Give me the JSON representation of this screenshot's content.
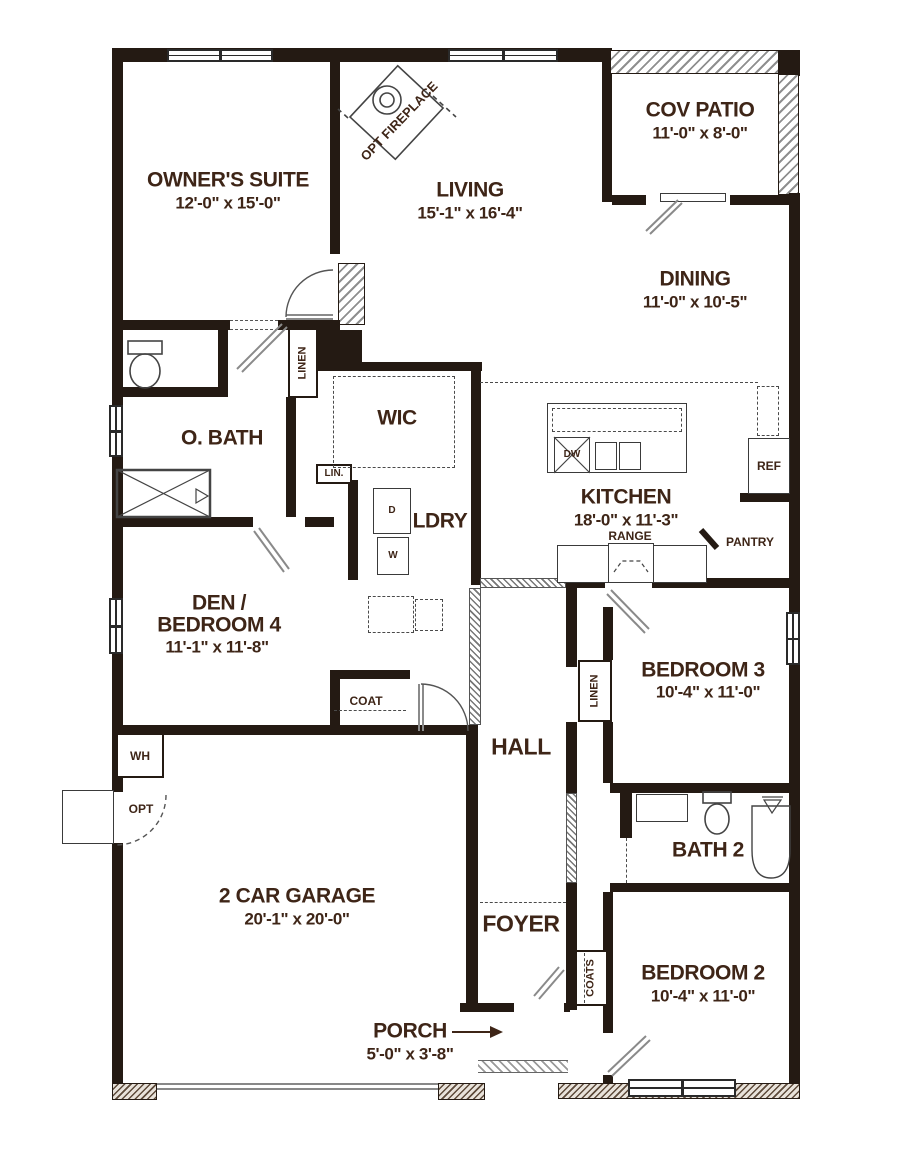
{
  "rooms": {
    "owners_suite": {
      "name": "OWNER'S SUITE",
      "dims": "12'-0\" x 15'-0\""
    },
    "living": {
      "name": "LIVING",
      "dims": "15'-1\" x 16'-4\""
    },
    "cov_patio": {
      "name": "COV PATIO",
      "dims": "11'-0\" x 8'-0\""
    },
    "dining": {
      "name": "DINING",
      "dims": "11'-0\" x 10'-5\""
    },
    "o_bath": {
      "name": "O. BATH"
    },
    "wic": {
      "name": "WIC"
    },
    "kitchen": {
      "name": "KITCHEN",
      "dims": "18'-0\" x 11'-3\""
    },
    "ldry": {
      "name": "LDRY"
    },
    "den_bedroom4": {
      "name_line1": "DEN /",
      "name_line2": "BEDROOM 4",
      "dims": "11'-1\" x 11'-8\""
    },
    "bedroom3": {
      "name": "BEDROOM 3",
      "dims": "10'-4\" x 11'-0\""
    },
    "hall": {
      "name": "HALL"
    },
    "bath2": {
      "name": "BATH 2"
    },
    "garage": {
      "name": "2 CAR GARAGE",
      "dims": "20'-1\" x 20'-0\""
    },
    "foyer": {
      "name": "FOYER"
    },
    "bedroom2": {
      "name": "BEDROOM 2",
      "dims": "10'-4\" x 11'-0\""
    },
    "porch": {
      "name": "PORCH",
      "dims": "5'-0\" x 3'-8\""
    }
  },
  "annotations": {
    "opt_fireplace": "OPT FIREPLACE",
    "linen_obath": "LINEN",
    "lin_abbrev": "LIN.",
    "linen_hall": "LINEN",
    "coat": "COAT",
    "coats": "COATS",
    "pantry": "PANTRY",
    "range": "RANGE",
    "ref": "REF",
    "dw": "DW",
    "dryer": "D",
    "washer": "W",
    "water_heater": "WH",
    "opt_door": "OPT"
  },
  "colors": {
    "wall": "#241a13",
    "text": "#3e2517",
    "hatch": "#8f8f8f",
    "door": "#8a8a8a"
  }
}
